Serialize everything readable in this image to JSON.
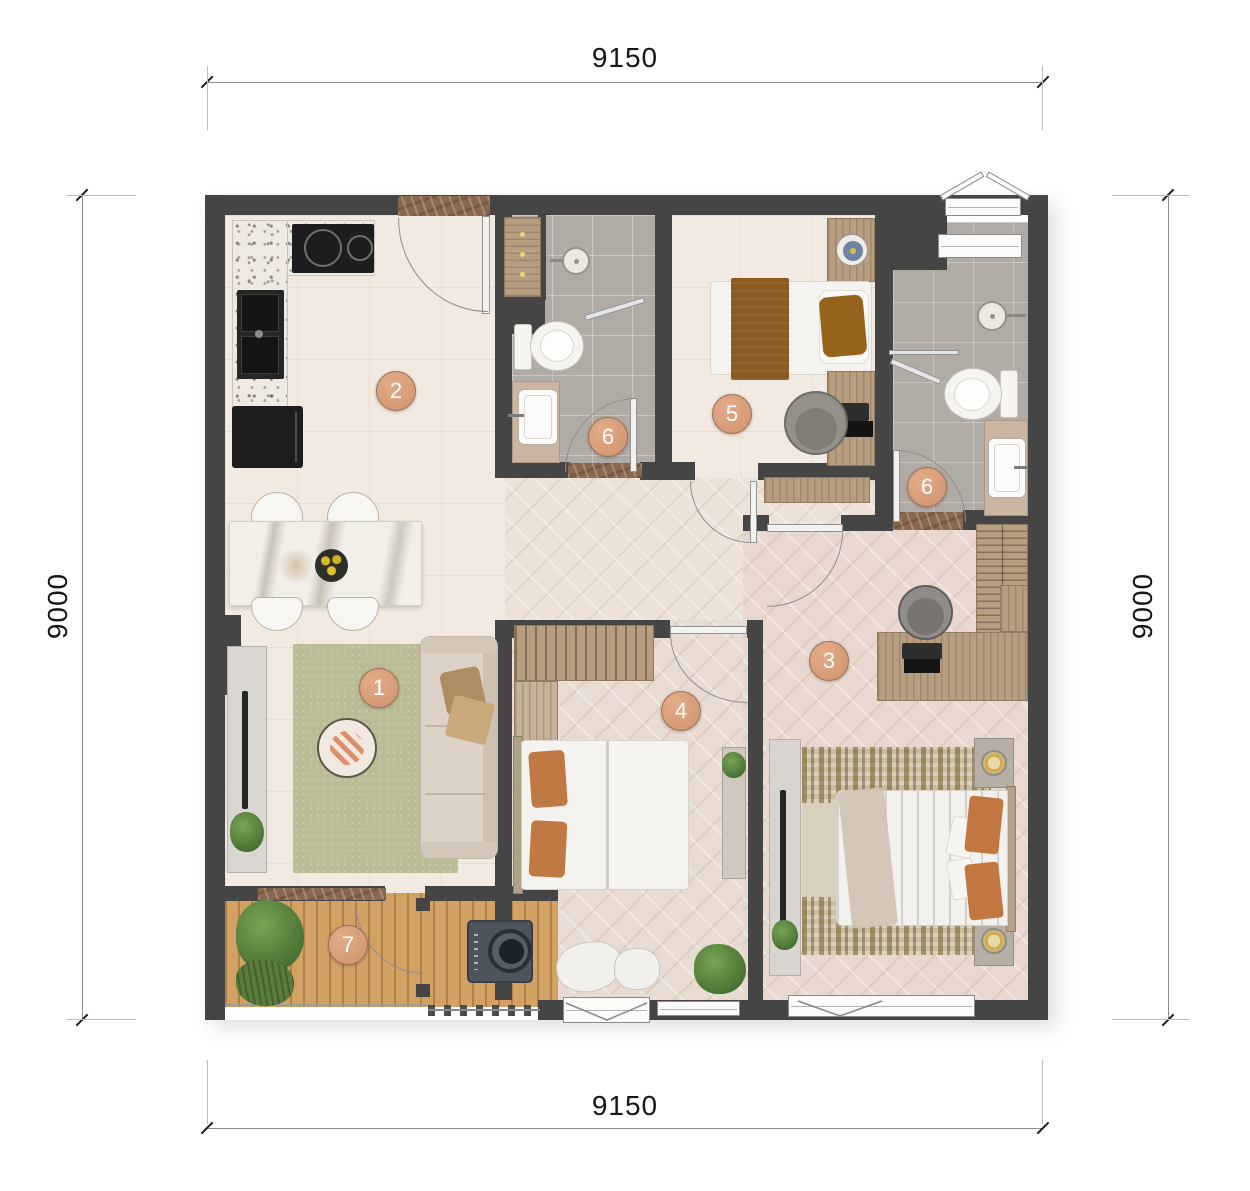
{
  "dimensions": {
    "top": "9150",
    "bottom": "9150",
    "left": "9000",
    "right": "9000"
  },
  "room_labels": [
    {
      "name": "living-room",
      "label": "1"
    },
    {
      "name": "kitchen-dining",
      "label": "2"
    },
    {
      "name": "master-bedroom",
      "label": "3"
    },
    {
      "name": "bedroom-2",
      "label": "4"
    },
    {
      "name": "bedroom-3",
      "label": "5"
    },
    {
      "name": "bathroom-1",
      "label": "6"
    },
    {
      "name": "bathroom-2",
      "label": "6"
    },
    {
      "name": "balcony",
      "label": "7"
    }
  ],
  "colors": {
    "wall": "#454545",
    "floor_cream": "#f2e9e0",
    "floor_tile_gray": "#b1aba5",
    "floor_herringbone": "#e8dbd2",
    "floor_deck": "#d2a164",
    "rug_green": "#babc95",
    "marble_threshold": "#8a6850",
    "label_circle": "#d59a75",
    "label_text": "#ffffff"
  }
}
